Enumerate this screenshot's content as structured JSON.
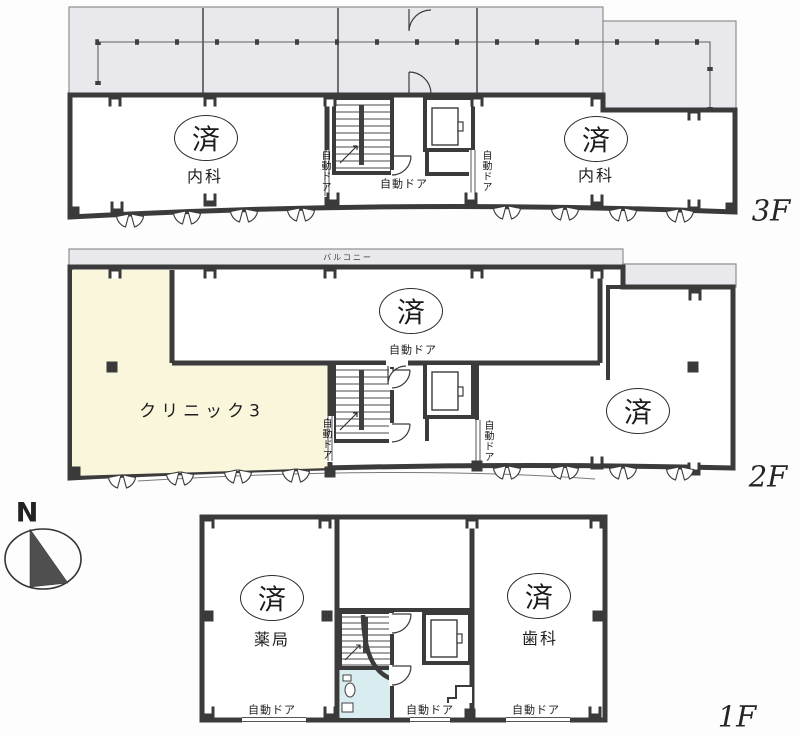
{
  "compass": {
    "label": "N"
  },
  "floor_3f": {
    "floor_label": "3F",
    "left_room": {
      "seal": "済",
      "name": "内科"
    },
    "right_room": {
      "seal": "済",
      "name": "内科"
    },
    "entrance_door_label": "自動ドア",
    "left_door_label": "自動ドア",
    "right_door_label": "自動ドア"
  },
  "floor_2f": {
    "floor_label": "2F",
    "balcony_label": "バルコニー",
    "upper_room": {
      "seal": "済",
      "door_label": "自動ドア"
    },
    "clinic_room": {
      "name": "クリニック3"
    },
    "right_room": {
      "seal": "済"
    },
    "left_door_label": "自動ドア",
    "right_door_label": "自動ドア"
  },
  "floor_1f": {
    "floor_label": "1F",
    "pharmacy_room": {
      "seal": "済",
      "name": "薬局",
      "door_label": "自動ドア"
    },
    "dental_room": {
      "seal": "済",
      "name": "歯科",
      "door_label": "自動ドア"
    },
    "center_door_label": "自動ドア"
  },
  "colors": {
    "wall": "#3b3b3b",
    "terrace_gray": "#e9e9ed",
    "clinic_cream": "#faf6dc",
    "toilet_cyan": "#d9ecef"
  }
}
